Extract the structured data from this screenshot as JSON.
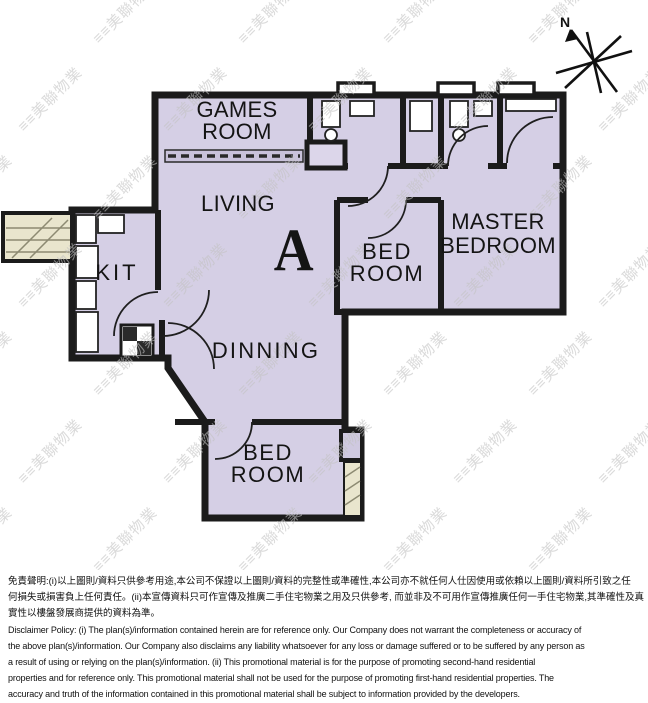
{
  "plan": {
    "fill_color": "#d5cfe5",
    "wall_color": "#1b1b1b",
    "duct_color": "#e9e5cd",
    "rooms": {
      "games_room": {
        "line1": "GAMES",
        "line2": "ROOM"
      },
      "living": {
        "label": "LIVING"
      },
      "unit": {
        "label": "A"
      },
      "kitchen": {
        "label": "KIT"
      },
      "bedroom_middle": {
        "line1": "BED",
        "line2": "ROOM"
      },
      "master_bedroom": {
        "line1": "MASTER",
        "line2": "BEDROOM"
      },
      "dining": {
        "label": "DINNING"
      },
      "bedroom_bottom": {
        "line1": "BED",
        "line2": "ROOM"
      }
    },
    "compass": {
      "label": "N"
    }
  },
  "watermark": {
    "text": "≡≡美聯物業",
    "color": "#c3c3c3",
    "opacity": 0.6,
    "rows": 7,
    "cols": 6,
    "x_start": -50,
    "y_start": 30,
    "x_step": 145,
    "y_step": 88,
    "row_offset": 70,
    "font_size": 15
  },
  "disclaimer": {
    "zh_lines": [
      "免責聲明:(i)以上圖則/資料只供參考用途,本公司不保證以上圖則/資料的完整性或準確性,本公司亦不就任何人仕因使用或依賴以上圖則/資料所引致之任",
      "何損失或損害負上任何責任。(ii)本宣傳資料只可作宣傳及推廣二手住宅物業之用及只供參考, 而並非及不可用作宣傳推廣任何一手住宅物業,其準確性及真",
      "實性以樓盤發展商提供的資料為準。"
    ],
    "en_lines": [
      "Disclaimer Policy: (i) The plan(s)/information contained herein are for reference only. Our Company does not warrant the completeness or accuracy of",
      "the above plan(s)/information. Our Company also disclaims any liability whatsoever for any loss or damage suffered or to be suffered by any person as",
      "a result of using or relying on the plan(s)/information. (ii) This promotional material is for the purpose of promoting second-hand residential",
      "properties and for reference only. This promotional material shall not be used for the purpose of promoting first-hand residential properties. The",
      "accuracy and truth of the information contained in this promotional material shall be subject to information provided by the developers."
    ]
  }
}
